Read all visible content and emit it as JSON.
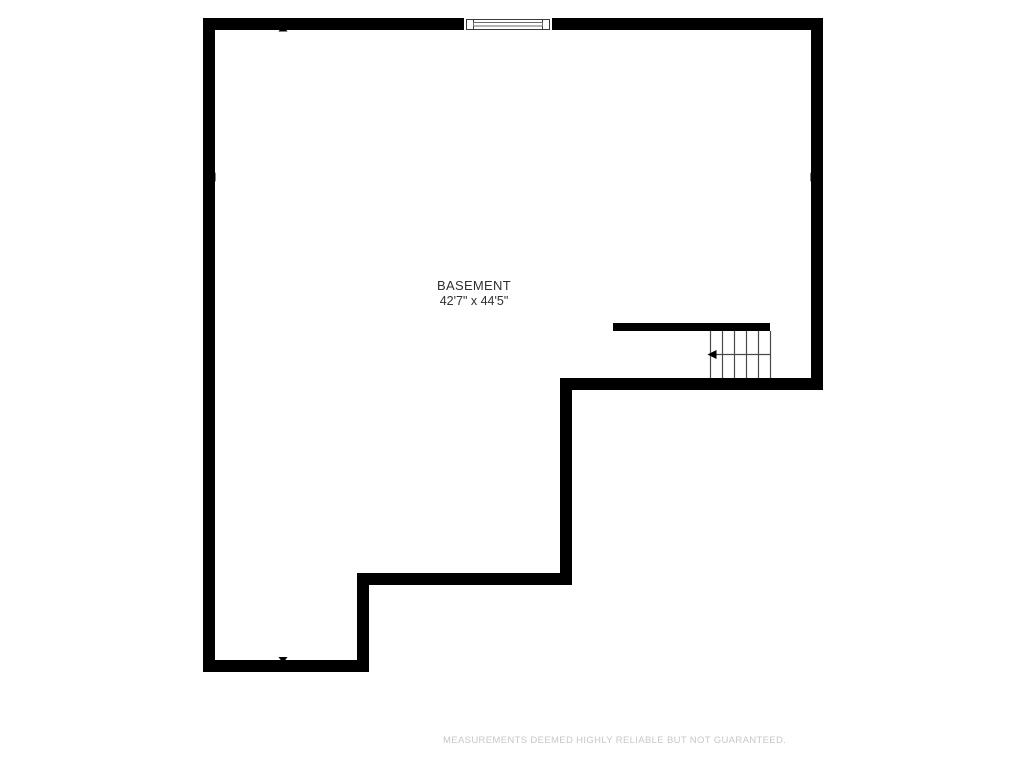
{
  "floorplan": {
    "room_name": "BASEMENT",
    "room_dimensions": "42'7\" x 44'5\"",
    "features": {
      "staircase": "staircase-with-down-direction-arrow",
      "window": "window-top-wall",
      "measure_arrows": [
        "up",
        "down",
        "left",
        "right"
      ]
    }
  },
  "footer": {
    "disclaimer": "MEASUREMENTS DEEMED HIGHLY RELIABLE BUT NOT GUARANTEED."
  },
  "colors": {
    "page-bg": "#ffffff",
    "wall-color": "#000000",
    "stair-color": "#4a4a4a",
    "window-color": "#3a3a3a",
    "window-pane-color": "#6a6a6a",
    "label-color": "#303030",
    "disclaimer-color": "#c7c7c7"
  }
}
